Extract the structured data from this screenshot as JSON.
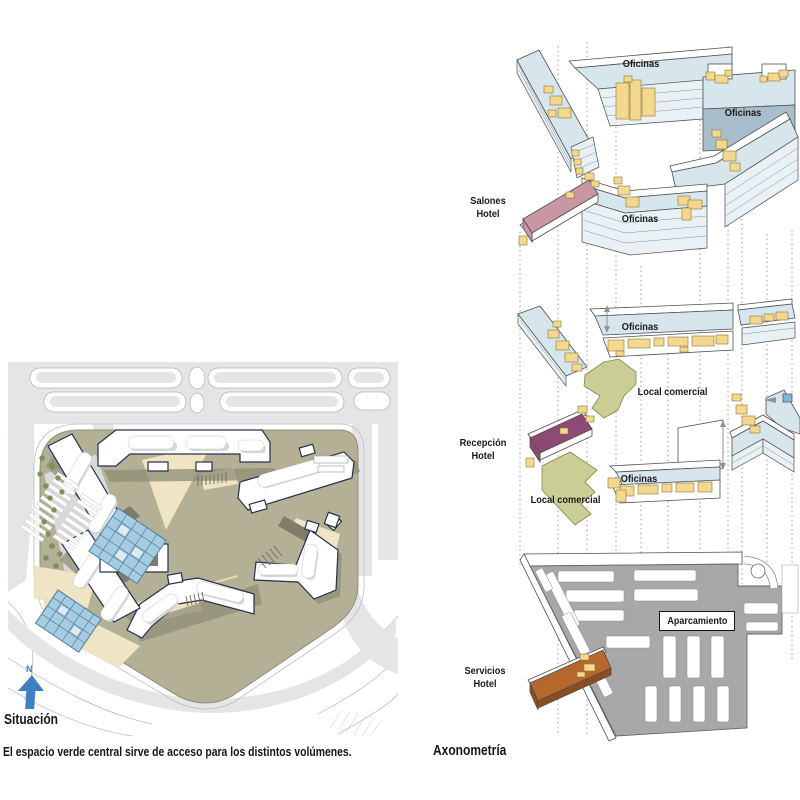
{
  "colors": {
    "offices": "#d7e6ec",
    "offices_light": "#e9f1f4",
    "offices_roof": "#a9becb",
    "circulation": "#f3d990",
    "circulation_stroke": "#8a7434",
    "salones": "#c997a4",
    "recepcion": "#8e4a74",
    "servicios": "#b5672e",
    "servicios_dark": "#8c4c1e",
    "comercial": "#cbce94",
    "comercial_stroke": "#83834f",
    "parking": "#a8a8a8",
    "guide": "#9b8f8f",
    "outline": "#4f4f4f",
    "plan_site": "#b3b095",
    "plan_shadow": "#8f8d74",
    "plan_beige": "#efe4c3",
    "plan_street": "#e5e5e7",
    "plan_bstroke": "#24304e",
    "plan_glass": "#a7cce0",
    "plan_glass_stroke": "#4d7fa4",
    "plan_tree": "#7c9557",
    "north": "#3f80c2",
    "text": "#1a1a1a"
  },
  "site_plan": {
    "title": "Situación",
    "caption": "El espacio verde central sirve de acceso para los distintos volúmenes.",
    "north_label": "N"
  },
  "axonometric": {
    "title": "Axonometría",
    "roof_level": {
      "oficinas_top": "Oficinas",
      "oficinas_right": "Oficinas",
      "oficinas_bottom": "Oficinas",
      "salones_line1": "Salones",
      "salones_line2": "Hotel"
    },
    "ground_level": {
      "oficinas_top": "Oficinas",
      "local_comercial_right": "Local comercial",
      "recepcion_line1": "Recepción",
      "recepcion_line2": "Hotel",
      "oficinas_bottom": "Oficinas",
      "local_comercial_bottom": "Local comercial"
    },
    "parking_level": {
      "aparcamiento": "Aparcamiento",
      "servicios_line1": "Servicios",
      "servicios_line2": "Hotel"
    }
  }
}
